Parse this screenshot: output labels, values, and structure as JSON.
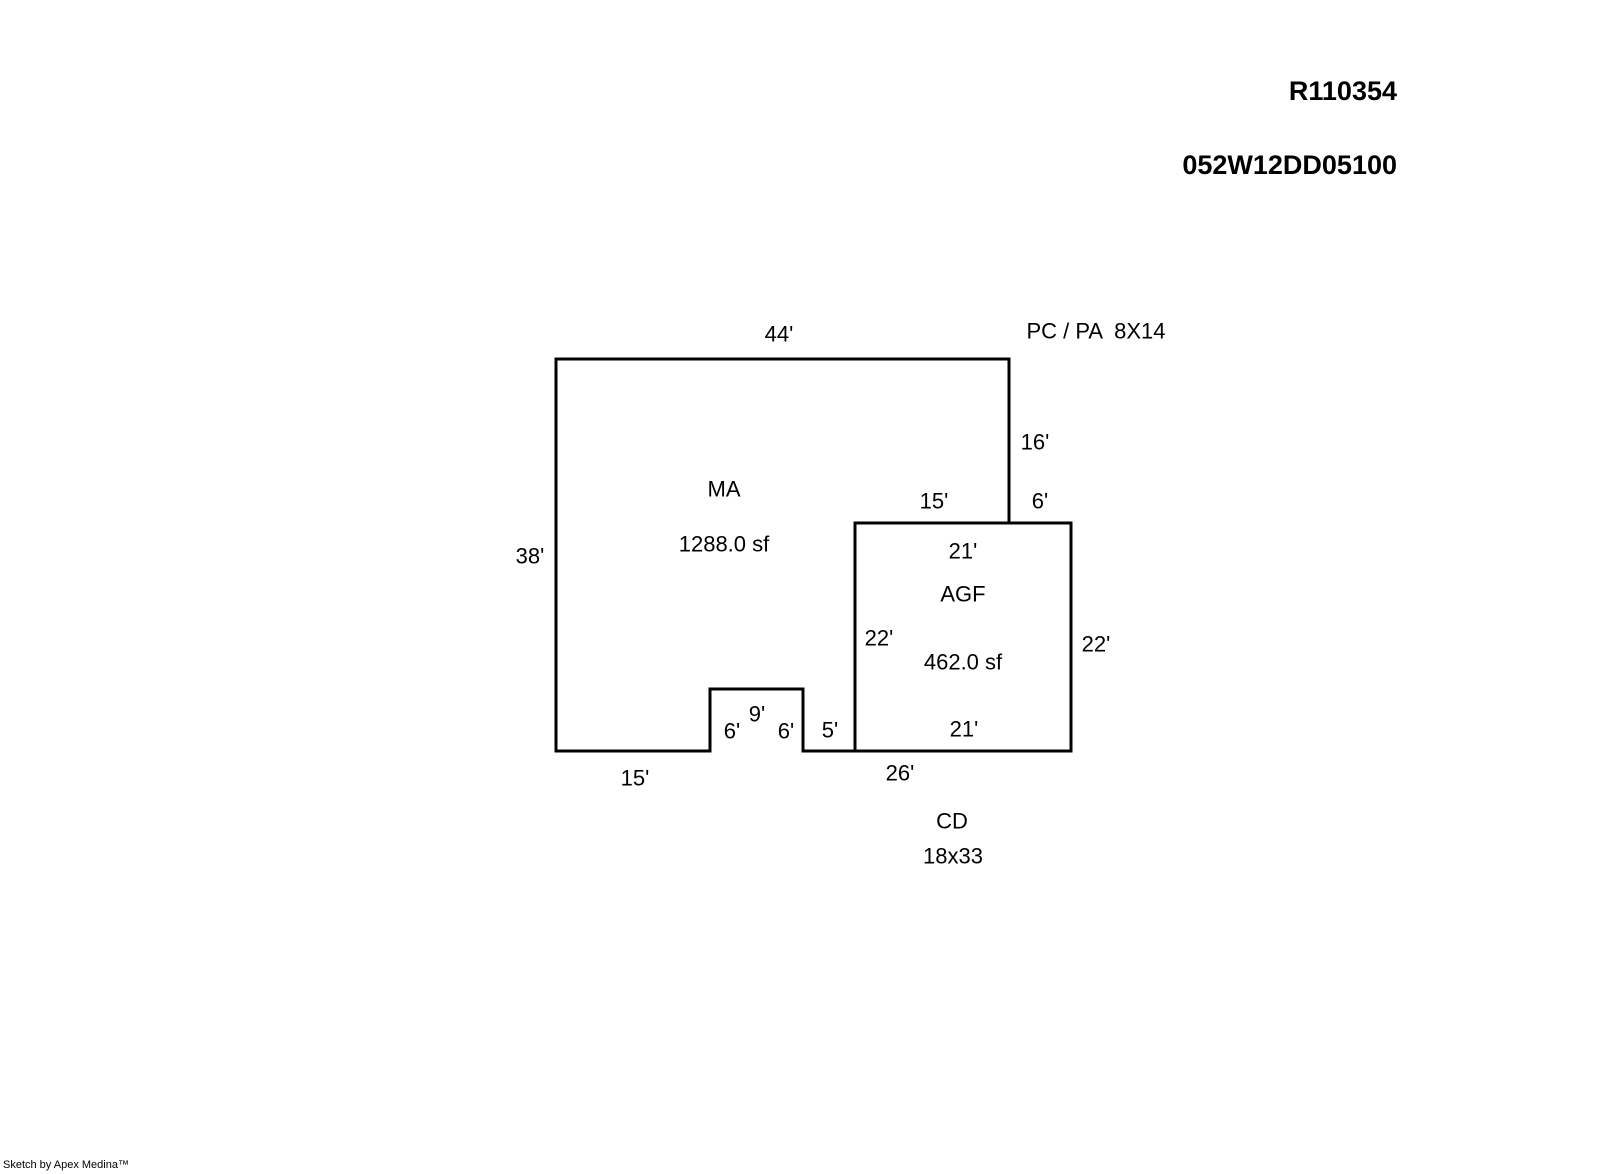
{
  "header": {
    "record_id": "R110354",
    "parcel_id": "052W12DD05100"
  },
  "footer": {
    "credit": "Sketch by Apex Medina™"
  },
  "diagram": {
    "stroke_color": "#000000",
    "stroke_width": 3,
    "areas": [
      {
        "code": "MA",
        "square_feet": "1288.0 sf"
      },
      {
        "code": "AGF",
        "square_feet": "462.0 sf"
      },
      {
        "code": "PC / PA",
        "size": "8X14"
      },
      {
        "code": "CD",
        "size": "18x33"
      }
    ],
    "shapes": [
      {
        "name": "ma-outline",
        "points": "556,359 1009,359 1009,523 855,523 855,751 803,751 803,689 710,689 710,751 556,751"
      },
      {
        "name": "agf-outline",
        "points": "855,523 1071,523 1071,751 855,751"
      }
    ],
    "labels": [
      {
        "name": "dim-44-top",
        "text": "44'",
        "x": 779,
        "y": 334
      },
      {
        "name": "porch-pc-pa-label",
        "text": "PC / PA  8X14",
        "x": 1096,
        "y": 331
      },
      {
        "name": "dim-16-right",
        "text": "16'",
        "x": 1035,
        "y": 442
      },
      {
        "name": "area-ma-code",
        "text": "MA",
        "x": 724,
        "y": 489
      },
      {
        "name": "dim-15-agf-top",
        "text": "15'",
        "x": 934,
        "y": 501
      },
      {
        "name": "dim-6-agf-top",
        "text": "6'",
        "x": 1040,
        "y": 501
      },
      {
        "name": "area-ma-sf",
        "text": "1288.0 sf",
        "x": 724,
        "y": 544
      },
      {
        "name": "dim-21-agf-top",
        "text": "21'",
        "x": 963,
        "y": 551
      },
      {
        "name": "dim-38-left",
        "text": "38'",
        "x": 530,
        "y": 556
      },
      {
        "name": "area-agf-code",
        "text": "AGF",
        "x": 963,
        "y": 594
      },
      {
        "name": "dim-22-agf-left",
        "text": "22'",
        "x": 879,
        "y": 638
      },
      {
        "name": "dim-22-agf-right",
        "text": "22'",
        "x": 1096,
        "y": 644
      },
      {
        "name": "area-agf-sf",
        "text": "462.0 sf",
        "x": 963,
        "y": 662
      },
      {
        "name": "dim-9-notch",
        "text": "9'",
        "x": 757,
        "y": 714
      },
      {
        "name": "dim-6-notch-left",
        "text": "6'",
        "x": 732,
        "y": 731
      },
      {
        "name": "dim-6-notch-right",
        "text": "6'",
        "x": 786,
        "y": 731
      },
      {
        "name": "dim-5-bottom",
        "text": "5'",
        "x": 830,
        "y": 730
      },
      {
        "name": "dim-21-agf-bottom",
        "text": "21'",
        "x": 964,
        "y": 729
      },
      {
        "name": "dim-15-bottom",
        "text": "15'",
        "x": 635,
        "y": 778
      },
      {
        "name": "dim-26-bottom",
        "text": "26'",
        "x": 900,
        "y": 773
      },
      {
        "name": "area-cd-code",
        "text": "CD",
        "x": 952,
        "y": 821
      },
      {
        "name": "area-cd-size",
        "text": "18x33",
        "x": 953,
        "y": 856
      }
    ]
  }
}
